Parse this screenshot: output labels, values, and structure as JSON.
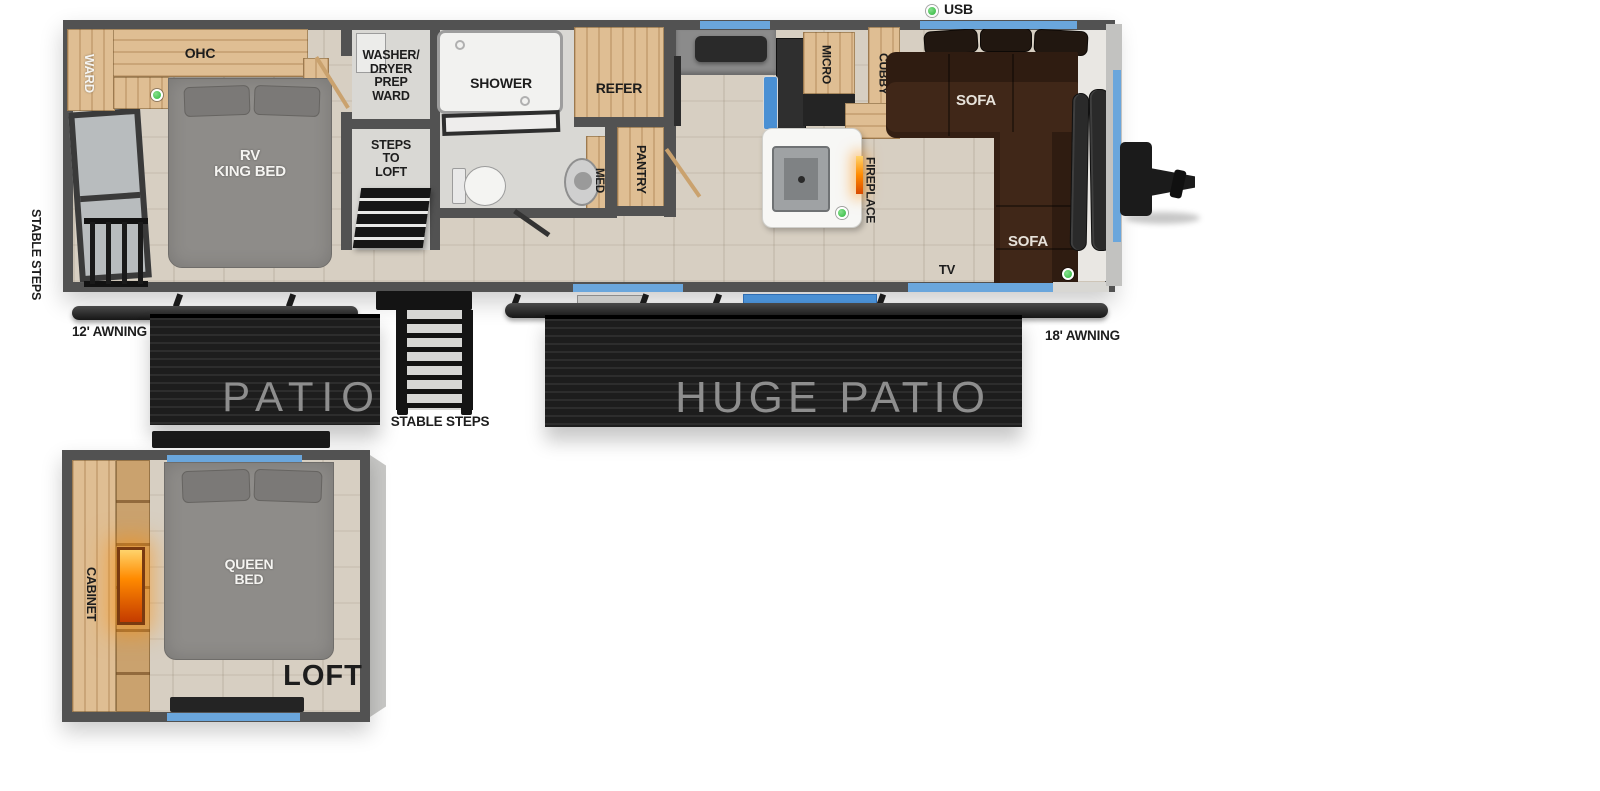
{
  "legend": {
    "usb": "USB"
  },
  "main": {
    "rear_steps_label": "STABLE STEPS",
    "ward": "WARD",
    "ohc": "OHC",
    "king_bed": "RV\nKING BED",
    "washer_dryer": "WASHER/\nDRYER\nPREP\nWARD",
    "steps_to_loft": "STEPS\nTO\nLOFT",
    "shower": "SHOWER",
    "med": "MED",
    "pantry": "PANTRY",
    "refer": "REFER",
    "micro": "MICRO",
    "cubby": "CUBBY",
    "fireplace": "FIREPLACE",
    "sofa_top": "SOFA",
    "sofa_front": "SOFA",
    "tv": "TV"
  },
  "exterior": {
    "awning_12": "12' AWNING",
    "awning_18": "18' AWNING",
    "patio": "PATIO",
    "huge_patio": "HUGE PATIO",
    "stable_steps": "STABLE STEPS"
  },
  "loft": {
    "cabinet": "CABINET",
    "queen_bed": "QUEEN\nBED",
    "title": "LOFT"
  },
  "colors": {
    "wall": "#525252",
    "wood": "#dfbe93",
    "wood_dark": "#caa26e",
    "floor": "#d7cfc2",
    "bath_floor": "#d9d8d4",
    "window_blue": "#6aa6dc",
    "slide_blue": "#4a90d4",
    "usb_green": "#2eb83c",
    "sofa_brown": "#402718",
    "deck": "#1d1d1d",
    "deck_text": "#8e8e8e",
    "fireplace_glow": "#ff8a00",
    "hitch_black": "#1b1b1b"
  }
}
